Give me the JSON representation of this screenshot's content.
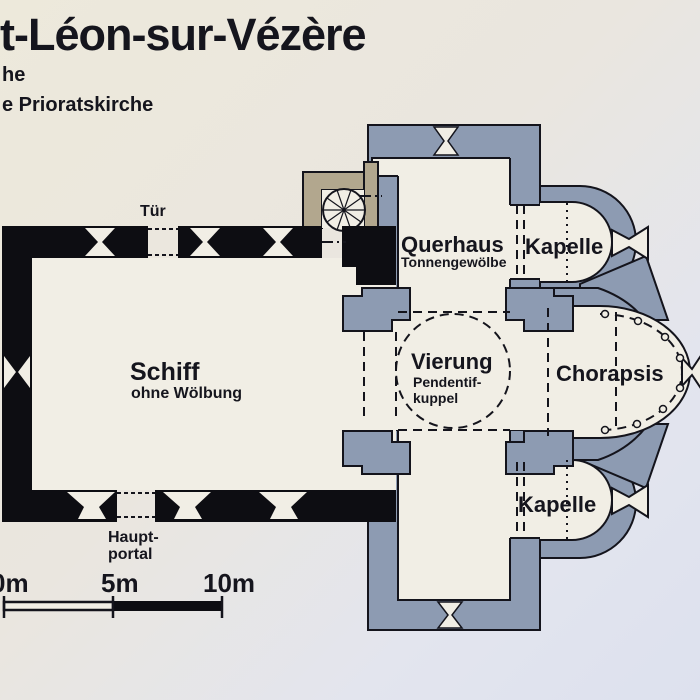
{
  "header": {
    "title": "t-Léon-sur-Vézère",
    "subtitle_line1": "he",
    "subtitle_line2": "e Prioratskirche"
  },
  "plan": {
    "labels": {
      "tuer": "Tür",
      "querhaus": "Querhaus",
      "querhaus_sub": "Tonnengewölbe",
      "kapelle_nord": "Kapelle",
      "schiff": "Schiff",
      "schiff_sub": "ohne Wölbung",
      "vierung": "Vierung",
      "vierung_sub1": "Pendentif-",
      "vierung_sub2": "kuppel",
      "chorapsis": "Chorapsis",
      "kapelle_sued": "Kapelle",
      "hauptportal_line1": "Haupt-",
      "hauptportal_line2": "portal"
    },
    "colors": {
      "vaulted_wall": "#8d9bb2",
      "nave_wall": "#0d0d12",
      "staircase_wall": "#b2a78e",
      "room_fill": "#f1eee5",
      "outline": "#14141c",
      "paper_top": "#ede9dc",
      "paper_bottom": "#dde1ee"
    }
  },
  "scale_bar": {
    "tick0": "0m",
    "tick5": "5m",
    "tick10": "10m"
  }
}
